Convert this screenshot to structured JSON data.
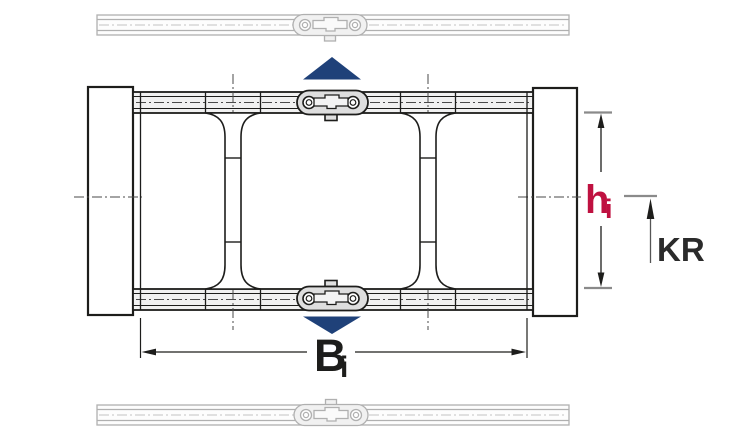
{
  "diagram": {
    "kind": "energy-chain cross-section technical drawing",
    "labels": {
      "inner_height_symbol": "h",
      "inner_height_subscript": "i",
      "inner_width_symbol": "B",
      "inner_width_subscript": "i",
      "bend_radius_label": "KR"
    },
    "colors": {
      "inner_height_label": "#bf1140",
      "inner_width_label": "#1d1d1b",
      "bend_radius_label": "#2b2b2b",
      "movement_arrow": "#1f4179",
      "drawing_line": "#1d1d1b",
      "ghost_line": "#b0b0b0",
      "tick_line": "#8a8a8a"
    }
  }
}
